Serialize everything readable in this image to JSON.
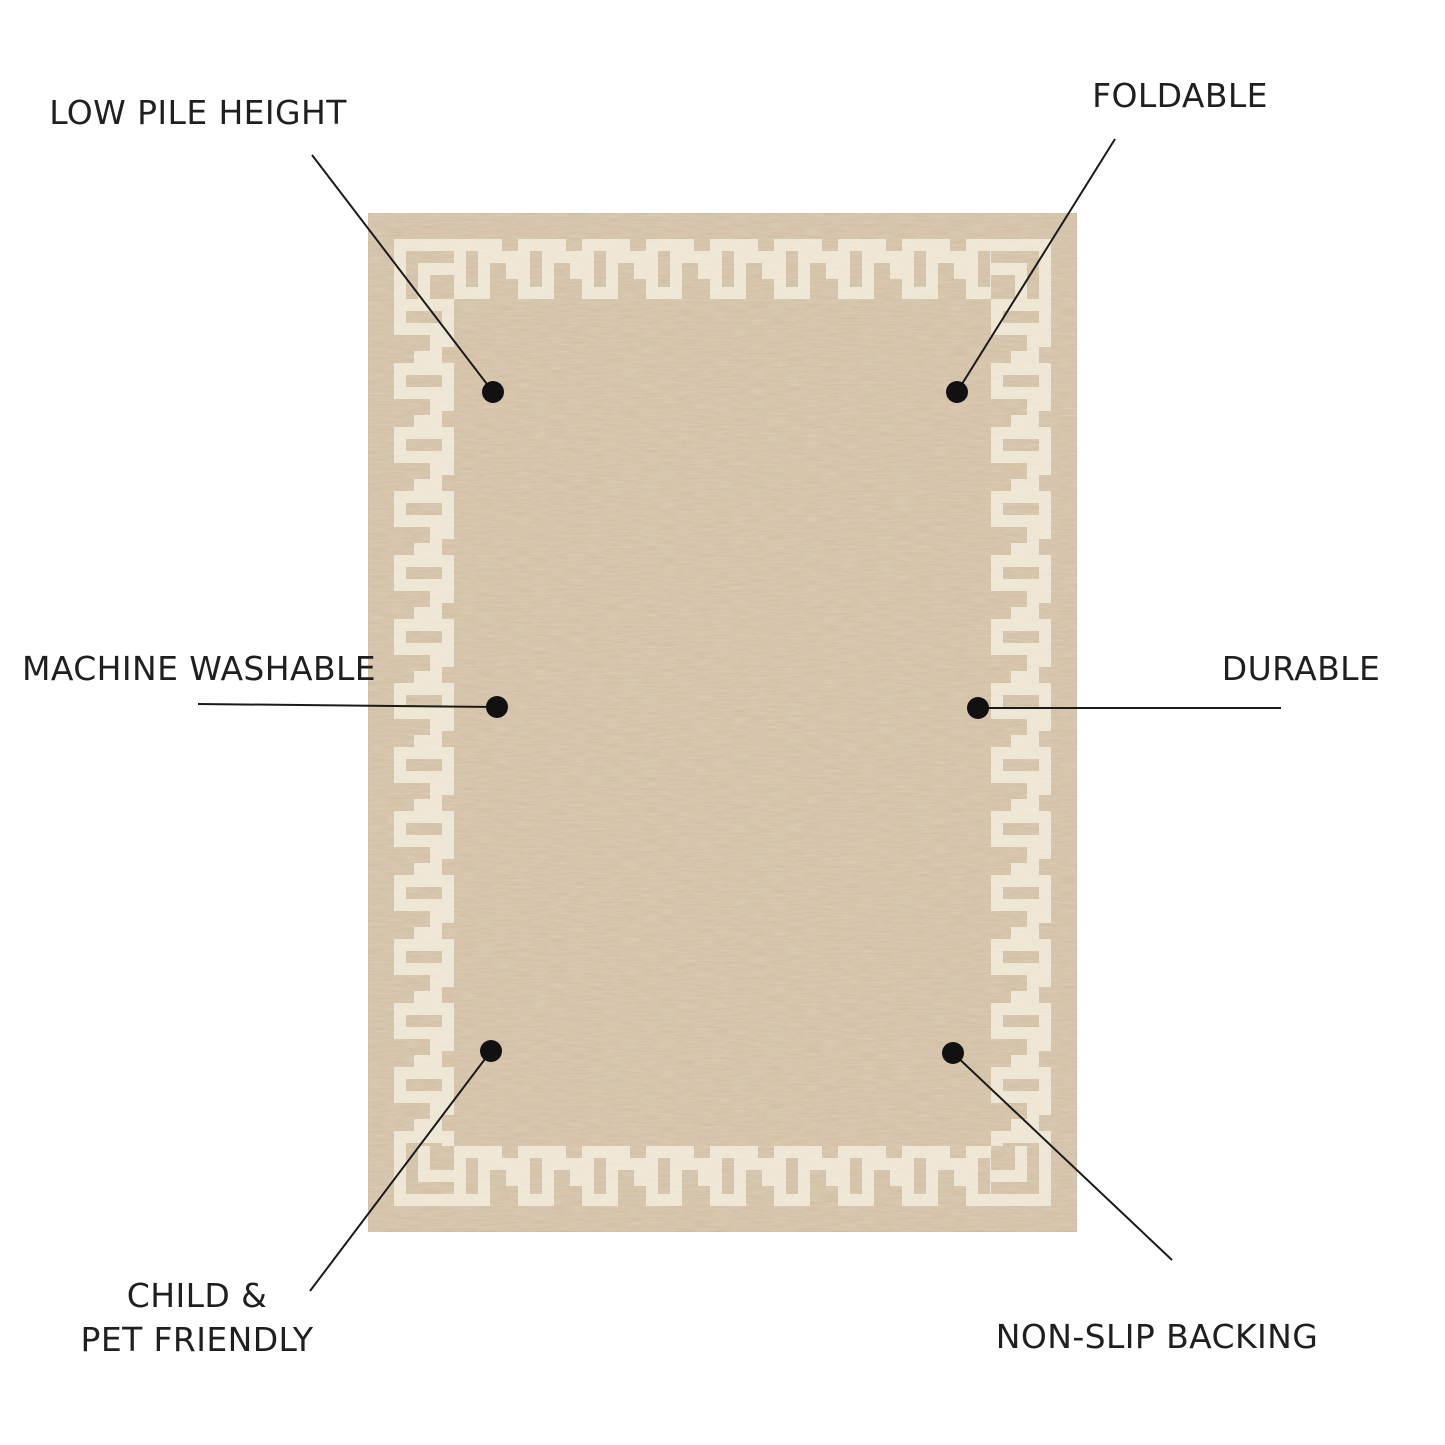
{
  "page": {
    "background_color": "#ffffff",
    "type": "product-feature-diagram"
  },
  "rug": {
    "description": "beige rug with cream greek key border",
    "colors": {
      "field": "#d2bfa2",
      "pattern_cream": "#f1e9d6",
      "edge": "#c9b69a"
    }
  },
  "annotation": {
    "line_color": "#1a1a1a",
    "dot_color": "#111111"
  },
  "callouts": {
    "low_pile": {
      "label": "LOW PILE HEIGHT"
    },
    "foldable": {
      "label": "FOLDABLE"
    },
    "machine_washable": {
      "label": "MACHINE WASHABLE"
    },
    "durable": {
      "label": "DURABLE"
    },
    "child_pet": {
      "line1": "CHILD &",
      "line2": "PET FRIENDLY"
    },
    "non_slip": {
      "label": "NON-SLIP BACKING"
    }
  }
}
